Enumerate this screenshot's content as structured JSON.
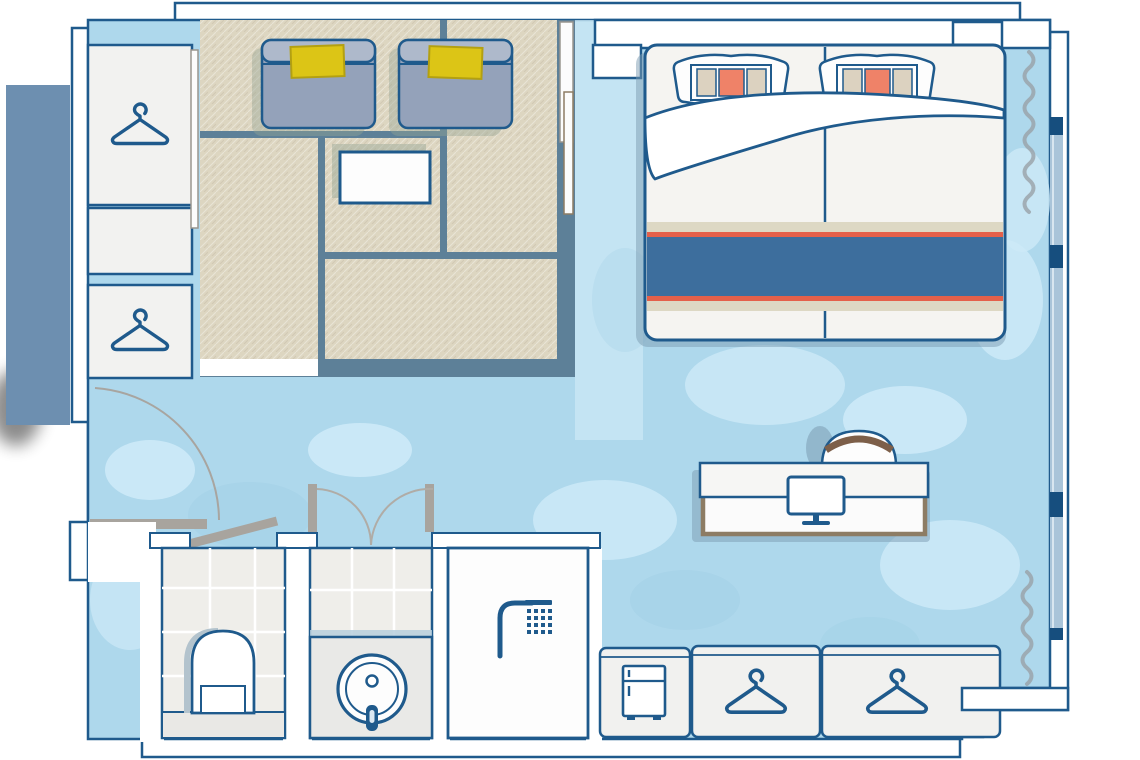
{
  "meta": {
    "kind": "floor-plan",
    "scene": "hotel-guest-room-top-view",
    "visible_text": "none"
  },
  "colors": {
    "line": "#1f5a8c",
    "lineDark": "#164e7e",
    "wall": "#ffffff",
    "floor": "#aed8ec",
    "floorLight": "#cdeaf8",
    "floorDark": "#9bcbe2",
    "corridor": "#c9e7f5",
    "exterior": "#6d8fb0",
    "tatami": "#ddd6c1",
    "platform": "#5d8098",
    "chairBody": "#94a2ba",
    "chairBack": "#aeb9cb",
    "cushion": "#dcc516",
    "cushionEdge": "#b3a011",
    "runnerBlue": "#3d6e9d",
    "accentRed": "#e4604a",
    "pillowOrange": "#ef8268",
    "pillowBeige": "#dcd2c0",
    "stripeBeige": "#ddd8c4",
    "tan": "#8d7c64",
    "brown": "#7d5f49",
    "doorGray": "#a8a49e",
    "curtain": "#99a1a8",
    "tile": "#efeeea",
    "counter": "#e9e9e7",
    "unit": "#f1f1ef",
    "window": "#a9c4d9",
    "shadowGreen": "#97a694",
    "shadowBlue": "#7c9cb2"
  },
  "areas": {
    "tatami_lounge": {
      "chairs": 2,
      "cushions_per_chair": 1,
      "low_table": 1,
      "mats": 5
    },
    "sleeping": {
      "bed": "double",
      "pillows": 2,
      "nightstands": 2,
      "runner_stripes": [
        "beige",
        "red",
        "blue",
        "red",
        "beige"
      ]
    },
    "work": {
      "desk": 1,
      "monitor": 1,
      "chair": 1
    },
    "bathroom": {
      "toilet_room": 1,
      "vanity_sink": 1,
      "shower_room": 1,
      "swing_doors": 2
    },
    "storage": {
      "tall_wardrobe_sections": 2,
      "entry_closet": 1,
      "bottom_units": 3,
      "minibar_fridge": 1,
      "hanger_icons": 4
    },
    "window_wall": {
      "glazing_strips": 3,
      "mullions": 4,
      "curtains": 2
    }
  },
  "icons": [
    "hanger-icon",
    "fridge-icon",
    "shower-icon",
    "monitor-icon",
    "toilet-icon",
    "sink-icon",
    "door-swing-arc",
    "curtain-squiggle"
  ]
}
